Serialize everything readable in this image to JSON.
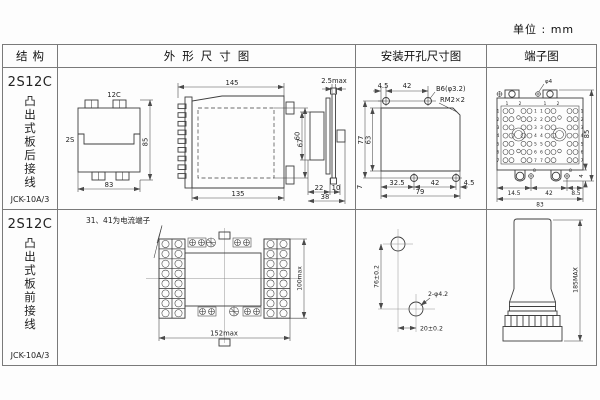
{
  "unit_label": "单位 : mm",
  "headers": {
    "structure": "结构",
    "outline": "外形尺寸图",
    "mounting": "安装开孔尺寸图",
    "terminal": "端子图"
  },
  "row1": {
    "structure": {
      "model": "2S12C",
      "mounting_type": "凸出式板后接线",
      "relay_type": "JCK-10A/3"
    },
    "outline": {
      "front": {
        "top_label": "12C",
        "side_label": "2S",
        "width": "83",
        "height": "85"
      },
      "side": {
        "top_width": "145",
        "bottom_width": "135",
        "inner_height": "67"
      },
      "rear": {
        "gap": "2.5max",
        "height": "60",
        "w1": "22",
        "w2": "10",
        "total_width": "38"
      }
    },
    "mounting": {
      "top_d1": "4.5",
      "top_d2": "42",
      "hole_label": "B6(φ3.2)",
      "screw_label": "RM2×2",
      "outer_height": "77",
      "inner_height": "63",
      "bottom_offset": "7",
      "bot_d1": "32.5",
      "bot_d2": "42",
      "bot_d3": "4.5",
      "total_width": "79"
    },
    "terminal": {
      "hole_label": "φ4",
      "top_nums": [
        "1",
        "2",
        "1",
        "2"
      ],
      "row_nums": [
        "1",
        "2",
        "3",
        "4",
        "5",
        "6",
        "7"
      ],
      "bottom_nums": [
        "8",
        "8"
      ],
      "height": "85",
      "offset": "4",
      "bot_d1": "14.5",
      "bot_d2": "42",
      "bot_d3": "8.5",
      "total_width": "83"
    }
  },
  "row2": {
    "structure": {
      "model": "2S12C",
      "mounting_type": "凸出式板前接线",
      "relay_type": "JCK-10A/3"
    },
    "outline": {
      "note": "31、41为电流端子",
      "total_width": "152max",
      "total_height": "100max"
    },
    "mounting": {
      "vertical": "76±0.2",
      "horizontal": "20±0.2",
      "holes_label": "2-φ4.2"
    },
    "terminal": {
      "height": "185MAX"
    }
  }
}
